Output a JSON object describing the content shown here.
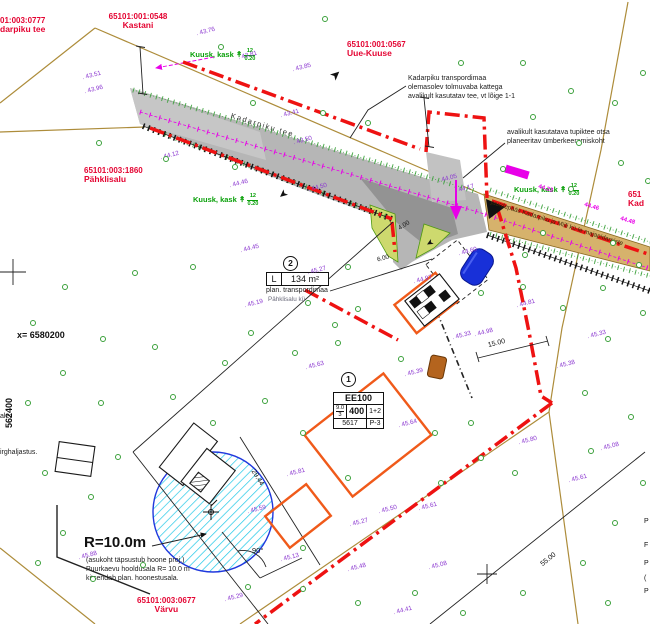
{
  "parcels": {
    "p0777": {
      "code": "01:003:0777",
      "name": "darpiku tee"
    },
    "p0548": {
      "code": "65101:001:0548",
      "name": "Kastani"
    },
    "p0567": {
      "code": "65101:001:0567",
      "name": "Uue-Kuuse"
    },
    "p1860": {
      "code": "65101:003:1860",
      "name": "Pähklisalu"
    },
    "pKad": {
      "code": "651",
      "name": "Kad"
    },
    "p0677": {
      "code": "65101:003:0677",
      "name": "Värvu"
    }
  },
  "roads": {
    "main_label": "Kadarpiku tee",
    "access_label": "juurdepääs Kadarpiku ja Miili kü-le majapidamiste"
  },
  "notes": {
    "road_l1": "Kadarpiku transpordimaa",
    "road_l2": "olemasolev tolmuvaba kattega",
    "road_l3": "avalikult kasutatav tee, vt lõige 1-1",
    "turn_l1": "avalikult kasutatava tupiktee otsa",
    "turn_l2": "planeeritav ümberkeeramiskoht"
  },
  "well": {
    "radius": "R=10.0m",
    "l1": "(asukoht täpsustub hoone proj.)",
    "l2": "Puurkaevu hooldusala R= 10.0 m",
    "l3": "kitsendab plan. hoonestusala."
  },
  "coords": {
    "x_label": "x= 6580200",
    "y_label": "562400"
  },
  "edge_fragments": {
    "left1": "ale:",
    "left2": "irghaljastus.",
    "right": [
      {
        "t": "P",
        "y": 518
      },
      {
        "t": "F",
        "y": 542
      },
      {
        "t": "P",
        "y": 560
      },
      {
        "t": "(",
        "y": 575
      },
      {
        "t": "P",
        "y": 588
      }
    ]
  },
  "area2": {
    "index": "2",
    "cell_l": "L",
    "area": "134 m²",
    "line1": "plan. transpordimaa",
    "line2": "Pähklisalu kü"
  },
  "building1": {
    "index": "1",
    "r1": "EE100",
    "r2a_top": "9.0",
    "r2a_bot": "3",
    "r2b": "400",
    "r2c": "1+2",
    "r3a": "5617",
    "r3b": "P-3"
  },
  "tree_groups": {
    "label": "Kuusk, kask",
    "glyph": "↟",
    "count": "12",
    "diameter": "0.20"
  },
  "dimensions": {
    "d29": "29.44",
    "d55": "55.00",
    "d15": "15.00",
    "d4": "4.00",
    "d6": "6.00",
    "angle": "90°"
  },
  "icons": {
    "slope_arrow": "➤"
  },
  "magenta_marks": [
    {
      "x": 538,
      "y": 186,
      "t": "44.23"
    },
    {
      "x": 584,
      "y": 204,
      "t": "44.46"
    },
    {
      "x": 620,
      "y": 218,
      "t": "44.48"
    }
  ],
  "elevations": [
    [
      82,
      72,
      "43.51"
    ],
    [
      84,
      86,
      "43.96"
    ],
    [
      196,
      28,
      "43.76"
    ],
    [
      238,
      52,
      "43.81"
    ],
    [
      292,
      64,
      "43.85"
    ],
    [
      280,
      110,
      "43.41"
    ],
    [
      293,
      137,
      "43.50"
    ],
    [
      160,
      152,
      "44.12"
    ],
    [
      229,
      180,
      "44.46"
    ],
    [
      308,
      184,
      "44.50"
    ],
    [
      240,
      245,
      "44.45"
    ],
    [
      438,
      175,
      "44.05"
    ],
    [
      455,
      185,
      "44.17"
    ],
    [
      458,
      248,
      "44.60"
    ],
    [
      413,
      276,
      "44.97"
    ],
    [
      307,
      267,
      "45.27"
    ],
    [
      244,
      300,
      "45.19"
    ],
    [
      474,
      329,
      "44.98"
    ],
    [
      516,
      300,
      "44.81"
    ],
    [
      587,
      331,
      "45.33"
    ],
    [
      556,
      361,
      "45.38"
    ],
    [
      452,
      332,
      "45.33"
    ],
    [
      305,
      362,
      "45.63"
    ],
    [
      404,
      369,
      "45.39"
    ],
    [
      398,
      420,
      "45.64"
    ],
    [
      286,
      469,
      "45.81"
    ],
    [
      247,
      506,
      "45.59"
    ],
    [
      78,
      552,
      "45.88"
    ],
    [
      349,
      519,
      "45.27"
    ],
    [
      378,
      506,
      "45.50"
    ],
    [
      418,
      503,
      "45.61"
    ],
    [
      347,
      564,
      "45.48"
    ],
    [
      280,
      554,
      "45.13"
    ],
    [
      224,
      594,
      "45.29"
    ],
    [
      393,
      607,
      "44.41"
    ],
    [
      428,
      562,
      "45.08"
    ],
    [
      600,
      443,
      "45.08"
    ],
    [
      568,
      475,
      "45.61"
    ],
    [
      518,
      437,
      "45.80"
    ]
  ],
  "trees": [
    [
      322,
      16
    ],
    [
      218,
      44
    ],
    [
      250,
      100
    ],
    [
      96,
      140
    ],
    [
      163,
      156
    ],
    [
      232,
      164
    ],
    [
      320,
      110
    ],
    [
      365,
      120
    ],
    [
      458,
      60
    ],
    [
      520,
      60
    ],
    [
      568,
      88
    ],
    [
      612,
      100
    ],
    [
      640,
      70
    ],
    [
      530,
      114
    ],
    [
      576,
      140
    ],
    [
      500,
      166
    ],
    [
      618,
      160
    ],
    [
      645,
      178
    ],
    [
      568,
      186
    ],
    [
      540,
      230
    ],
    [
      610,
      240
    ],
    [
      522,
      252
    ],
    [
      636,
      262
    ],
    [
      600,
      285
    ],
    [
      560,
      305
    ],
    [
      640,
      310
    ],
    [
      605,
      336
    ],
    [
      345,
      264
    ],
    [
      305,
      300
    ],
    [
      355,
      306
    ],
    [
      190,
      264
    ],
    [
      132,
      270
    ],
    [
      62,
      284
    ],
    [
      30,
      320
    ],
    [
      100,
      336
    ],
    [
      152,
      344
    ],
    [
      248,
      330
    ],
    [
      222,
      360
    ],
    [
      292,
      350
    ],
    [
      335,
      340
    ],
    [
      60,
      370
    ],
    [
      25,
      400
    ],
    [
      98,
      400
    ],
    [
      170,
      394
    ],
    [
      262,
      398
    ],
    [
      210,
      420
    ],
    [
      115,
      454
    ],
    [
      42,
      470
    ],
    [
      88,
      494
    ],
    [
      60,
      530
    ],
    [
      35,
      560
    ],
    [
      90,
      576
    ],
    [
      140,
      562
    ],
    [
      245,
      584
    ],
    [
      300,
      586
    ],
    [
      355,
      600
    ],
    [
      412,
      590
    ],
    [
      460,
      610
    ],
    [
      520,
      590
    ],
    [
      580,
      560
    ],
    [
      612,
      520
    ],
    [
      640,
      480
    ],
    [
      588,
      448
    ],
    [
      478,
      455
    ],
    [
      438,
      480
    ],
    [
      512,
      470
    ],
    [
      300,
      545
    ],
    [
      345,
      475
    ],
    [
      300,
      430
    ],
    [
      432,
      430
    ],
    [
      468,
      420
    ],
    [
      398,
      356
    ],
    [
      332,
      322
    ],
    [
      478,
      290
    ],
    [
      520,
      284
    ],
    [
      582,
      390
    ],
    [
      628,
      414
    ],
    [
      605,
      600
    ]
  ],
  "colors": {
    "boundary_red": "#ee1212",
    "parcel_red": "#e40432",
    "elev_purple": "#8a35d0",
    "tree_green": "#3aa03a",
    "magenta": "#e800e8",
    "khaki": "#ad8c3a",
    "building_orange": "#f05a1a",
    "road_gray": "#b6b6b6",
    "access_tan": "#d6b26c",
    "well_cyan": "#22c8e8",
    "well_blue": "#2038dd",
    "car_blue": "#1830d8"
  }
}
